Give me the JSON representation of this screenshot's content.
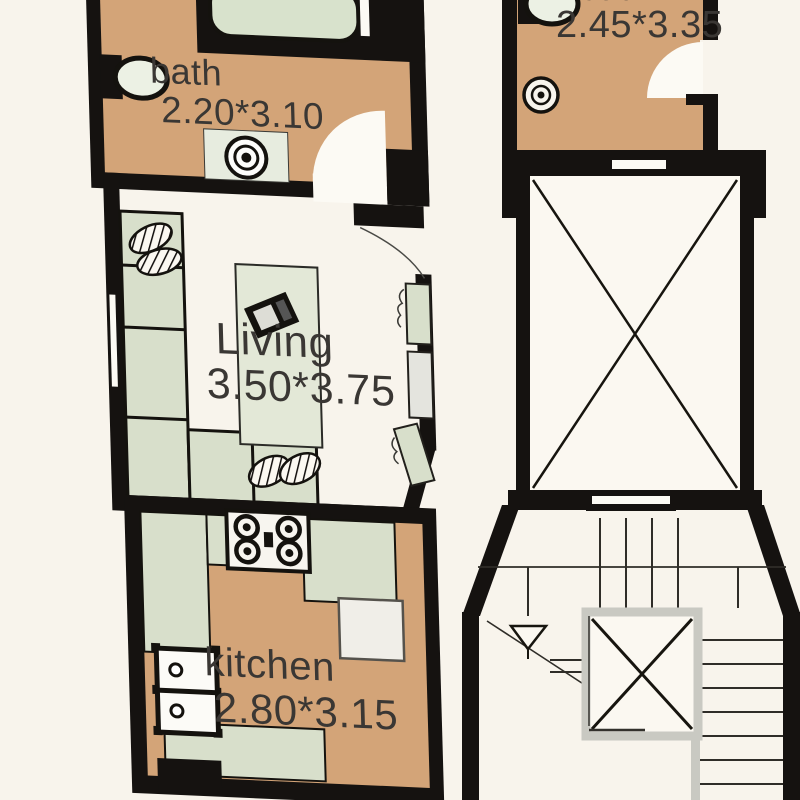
{
  "page": {
    "type": "apartment floor plan drawing",
    "view": "top-down plan with furnished rooms, elevator shaft and staircase core"
  },
  "rooms": [
    {
      "id": "bath-left",
      "label": "bath",
      "dimensions": "2.20*3.10",
      "fixtures": [
        "bathtub",
        "toilet",
        "floor-drain",
        "door-swing"
      ]
    },
    {
      "id": "living",
      "label": "Living",
      "dimensions": "3.50*3.75",
      "fixtures": [
        "l-shaped-sofa",
        "hatched-cushions",
        "rug-table",
        "tv-console",
        "entry-door-swing",
        "window"
      ]
    },
    {
      "id": "kitchen",
      "label": "kitchen",
      "dimensions": "2.80*3.15",
      "fixtures": [
        "gas-stove",
        "double-sink",
        "counters",
        "appliance"
      ]
    },
    {
      "id": "bath-right",
      "label": "bath",
      "dimensions": "2.45*3.35",
      "fixtures": [
        "toilet",
        "floor-drain",
        "door-swing"
      ]
    }
  ],
  "core": {
    "elevator": "elevator shaft crossed with X diagonals, door slits top and bottom",
    "staircase": "U-shaped stair around central X-crossed landing void",
    "direction_arrow": "triangular arrowhead with diagonal run line (up direction)"
  },
  "icons": {
    "toilet": "toilet-icon",
    "bathtub": "bathtub-icon",
    "floor_drain": "floor-drain-icon",
    "stove": "stove-icon",
    "sink": "sink-icon",
    "door_swing": "door-arc",
    "stairs_arrow": "stairs-direction-arrow"
  },
  "colors": {
    "background": "#f8f4ec",
    "wall": "#151210",
    "bath_kitchen_floor": "#d3a478",
    "furniture_green": "#d8dfcb",
    "interior_white": "#fbf8f1",
    "appliance_gray": "#e4e4de",
    "stair_line": "#2f2d28",
    "landing_border": "#c9c9c2",
    "label_text": "#3a3734"
  }
}
